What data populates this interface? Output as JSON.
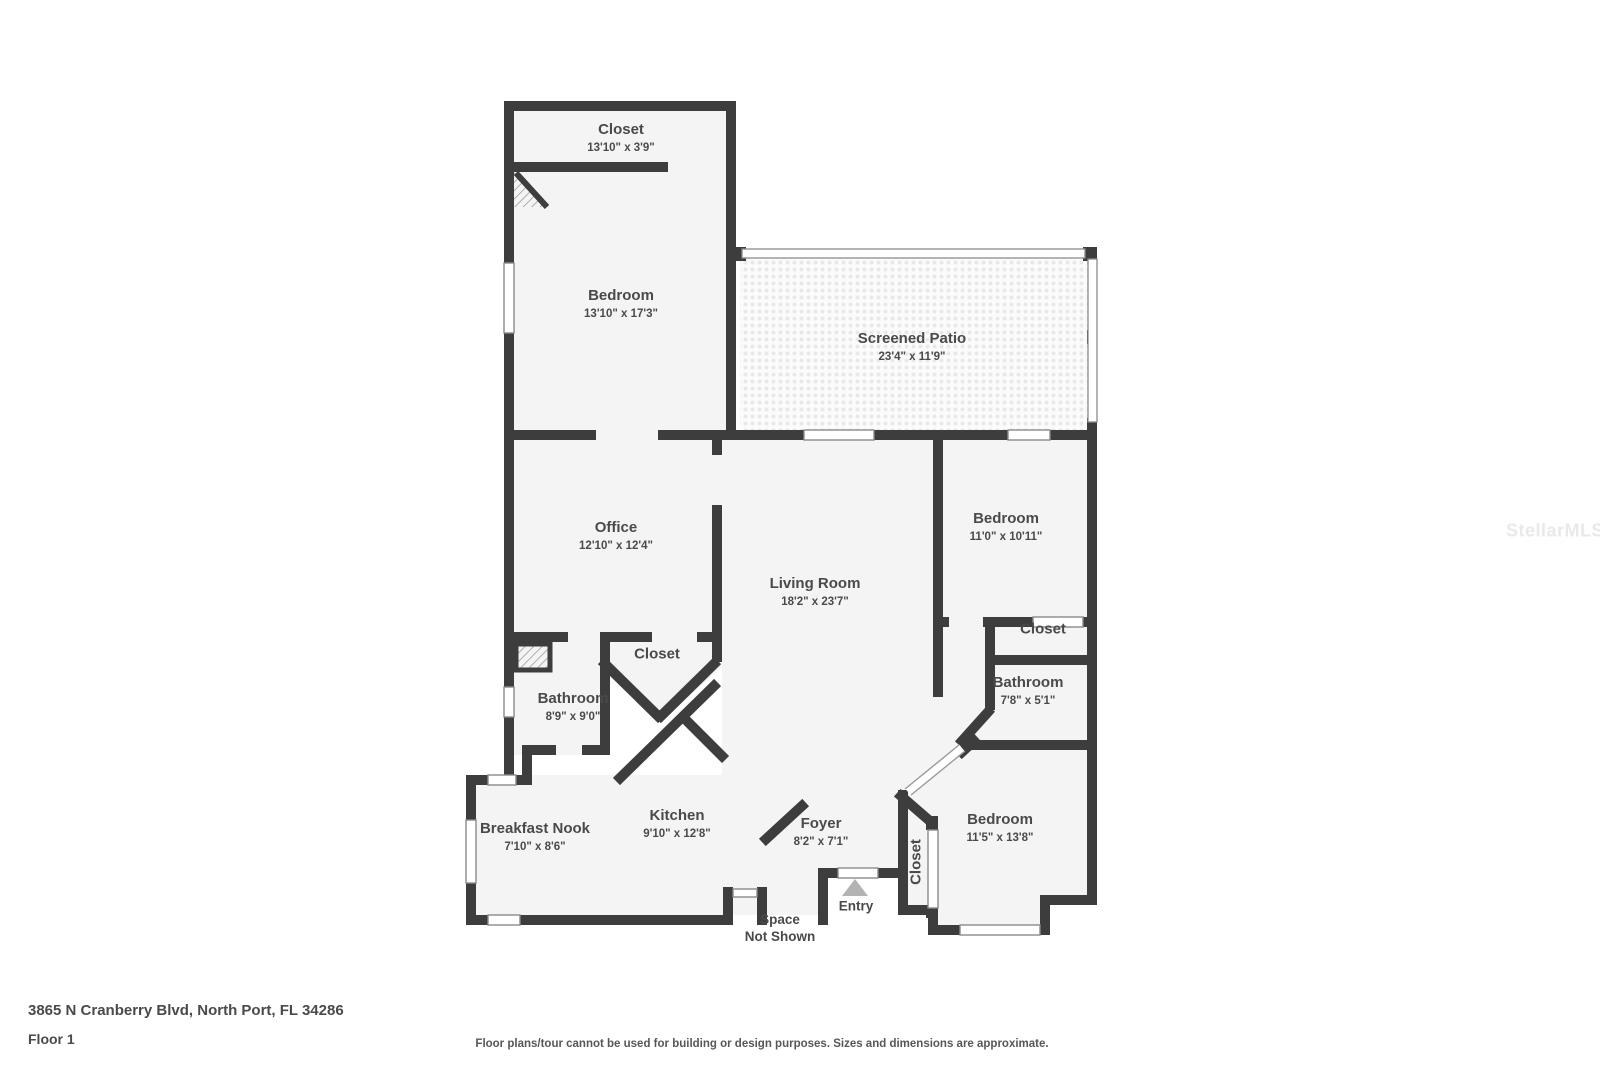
{
  "colors": {
    "wall": "#3d3d3d",
    "floor": "#f4f4f4",
    "label_text": "#4a4a4a",
    "entry_triangle": "#b3b3b3",
    "watermark": "#e9e9e9"
  },
  "rooms": [
    {
      "id": "closet-top",
      "name": "Closet",
      "dims": "13'10\" x 3'9\"",
      "x": 621,
      "y": 138
    },
    {
      "id": "bedroom-top",
      "name": "Bedroom",
      "dims": "13'10\" x 17'3\"",
      "x": 621,
      "y": 304
    },
    {
      "id": "screened-patio",
      "name": "Screened Patio",
      "dims": "23'4\" x 11'9\"",
      "x": 912,
      "y": 347
    },
    {
      "id": "office",
      "name": "Office",
      "dims": "12'10\" x 12'4\"",
      "x": 616,
      "y": 536
    },
    {
      "id": "living-room",
      "name": "Living Room",
      "dims": "18'2\" x 23'7\"",
      "x": 815,
      "y": 592
    },
    {
      "id": "bedroom-right",
      "name": "Bedroom",
      "dims": "11'0\" x 10'11\"",
      "x": 1006,
      "y": 527
    },
    {
      "id": "closet-right",
      "name": "Closet",
      "dims": "",
      "x": 1043,
      "y": 630
    },
    {
      "id": "bathroom-right",
      "name": "Bathroom",
      "dims": "7'8\" x 5'1\"",
      "x": 1028,
      "y": 691
    },
    {
      "id": "closet-middle",
      "name": "Closet",
      "dims": "",
      "x": 657,
      "y": 655
    },
    {
      "id": "bathroom-left",
      "name": "Bathroom",
      "dims": "8'9\" x 9'0\"",
      "x": 573,
      "y": 707
    },
    {
      "id": "breakfast-nook",
      "name": "Breakfast Nook",
      "dims": "7'10\" x 8'6\"",
      "x": 535,
      "y": 837
    },
    {
      "id": "kitchen",
      "name": "Kitchen",
      "dims": "9'10\" x 12'8\"",
      "x": 677,
      "y": 824
    },
    {
      "id": "foyer",
      "name": "Foyer",
      "dims": "8'2\" x 7'1\"",
      "x": 821,
      "y": 832
    },
    {
      "id": "bedroom-bottom",
      "name": "Bedroom",
      "dims": "11'5\" x 13'8\"",
      "x": 1000,
      "y": 828
    },
    {
      "id": "closet-foyer",
      "name": "Closet",
      "dims": "",
      "x": 917,
      "y": 862,
      "rotate": true
    },
    {
      "id": "entry",
      "name": "Entry",
      "dims": "",
      "x": 856,
      "y": 907,
      "small": true
    },
    {
      "id": "space-not-shown",
      "name": "Space",
      "dims": "Not Shown",
      "x": 780,
      "y": 929,
      "small": true
    }
  ],
  "footer": {
    "address": "3865 N Cranberry Blvd, North Port, FL 34286",
    "floor": "Floor 1",
    "disclaimer": "Floor plans/tour cannot be used for building or design purposes. Sizes and dimensions are approximate."
  },
  "watermark": "StellarMLS"
}
